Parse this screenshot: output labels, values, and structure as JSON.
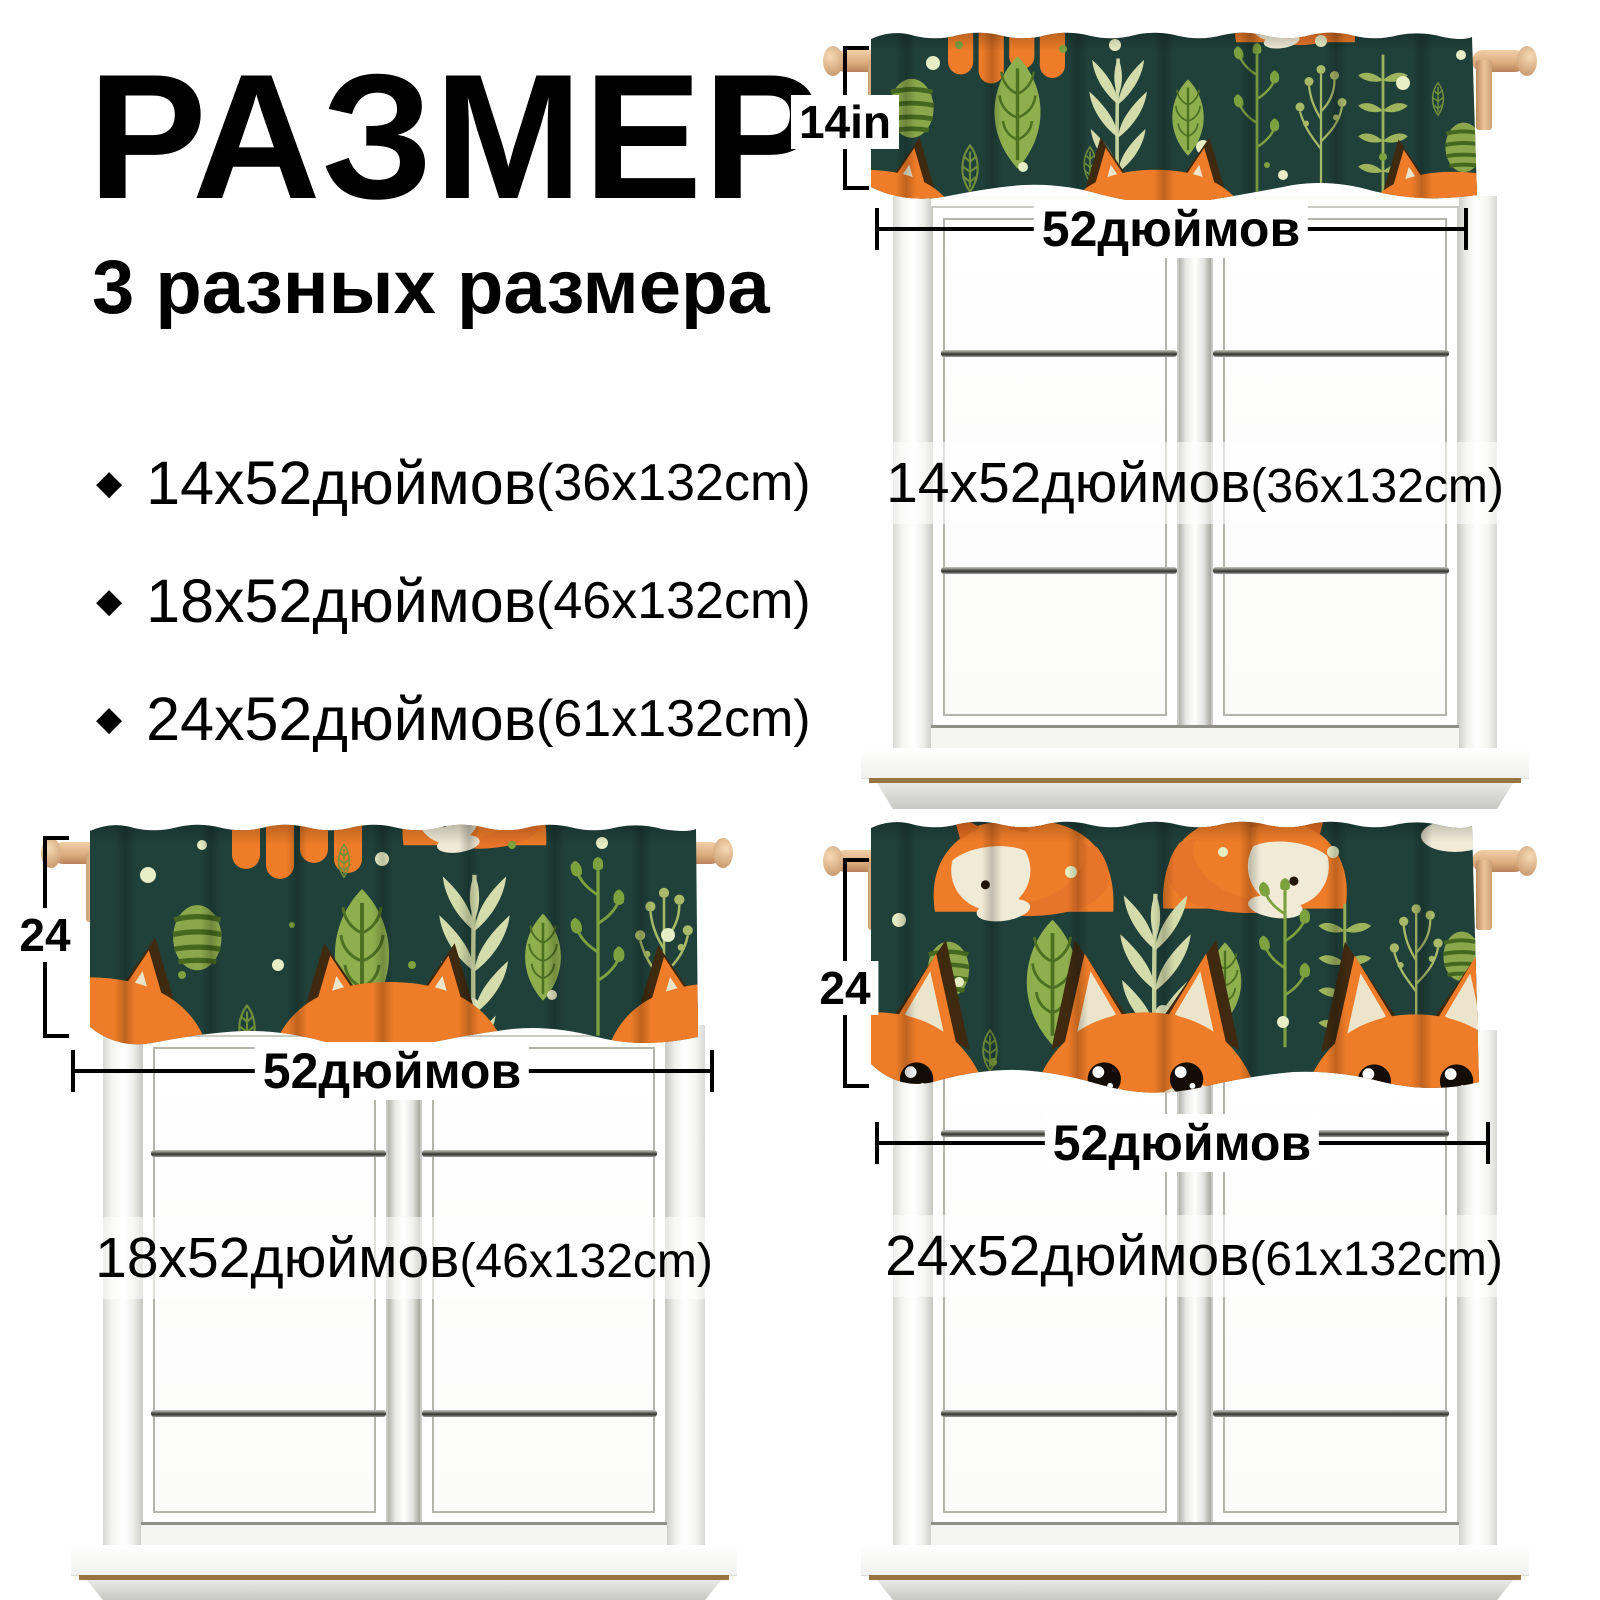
{
  "header": {
    "title": "РАЗМЕР",
    "subtitle": "3 разных размера"
  },
  "size_list": {
    "bullet": "◆",
    "items": [
      {
        "size": "14x52дюймов",
        "cm": "(36x132cm)"
      },
      {
        "size": "18x52дюймов",
        "cm": "(46x132cm)"
      },
      {
        "size": "24x52дюймов",
        "cm": "(61x132cm)"
      }
    ]
  },
  "panels": [
    {
      "name": "valance-14x52",
      "height_label": "14in",
      "width_label": "52дюймов",
      "window_label": {
        "size": "14x52дюймов",
        "cm": "(36x132cm)"
      }
    },
    {
      "name": "valance-18x52",
      "height_label": "24",
      "width_label": "52дюймов",
      "window_label": {
        "size": "18x52дюймов",
        "cm": "(46x132cm)"
      }
    },
    {
      "name": "valance-24x52",
      "height_label": "24",
      "width_label": "52дюймов",
      "window_label": {
        "size": "24x52дюймов",
        "cm": "(61x132cm)"
      }
    }
  ],
  "colors": {
    "fabric_green": "#20413a",
    "leaf_olive": "#8faf4e",
    "leaf_sage": "#d4dcab",
    "leaf_dark": "#46671f",
    "fox_orange": "#ee7c28",
    "fox_cream": "#ece5cc",
    "ear_brown": "#3f2a10",
    "wood": "#dcae80",
    "dimension_black": "#000000"
  },
  "pattern_motifs": [
    "fox-peek",
    "fox-face",
    "fox-sleeping",
    "big-leaf",
    "sage-sprig",
    "outline-leaf",
    "bell-flower-sprig",
    "berry-sprig",
    "striped-leaf",
    "pair-leaf-sprig",
    "dots"
  ]
}
